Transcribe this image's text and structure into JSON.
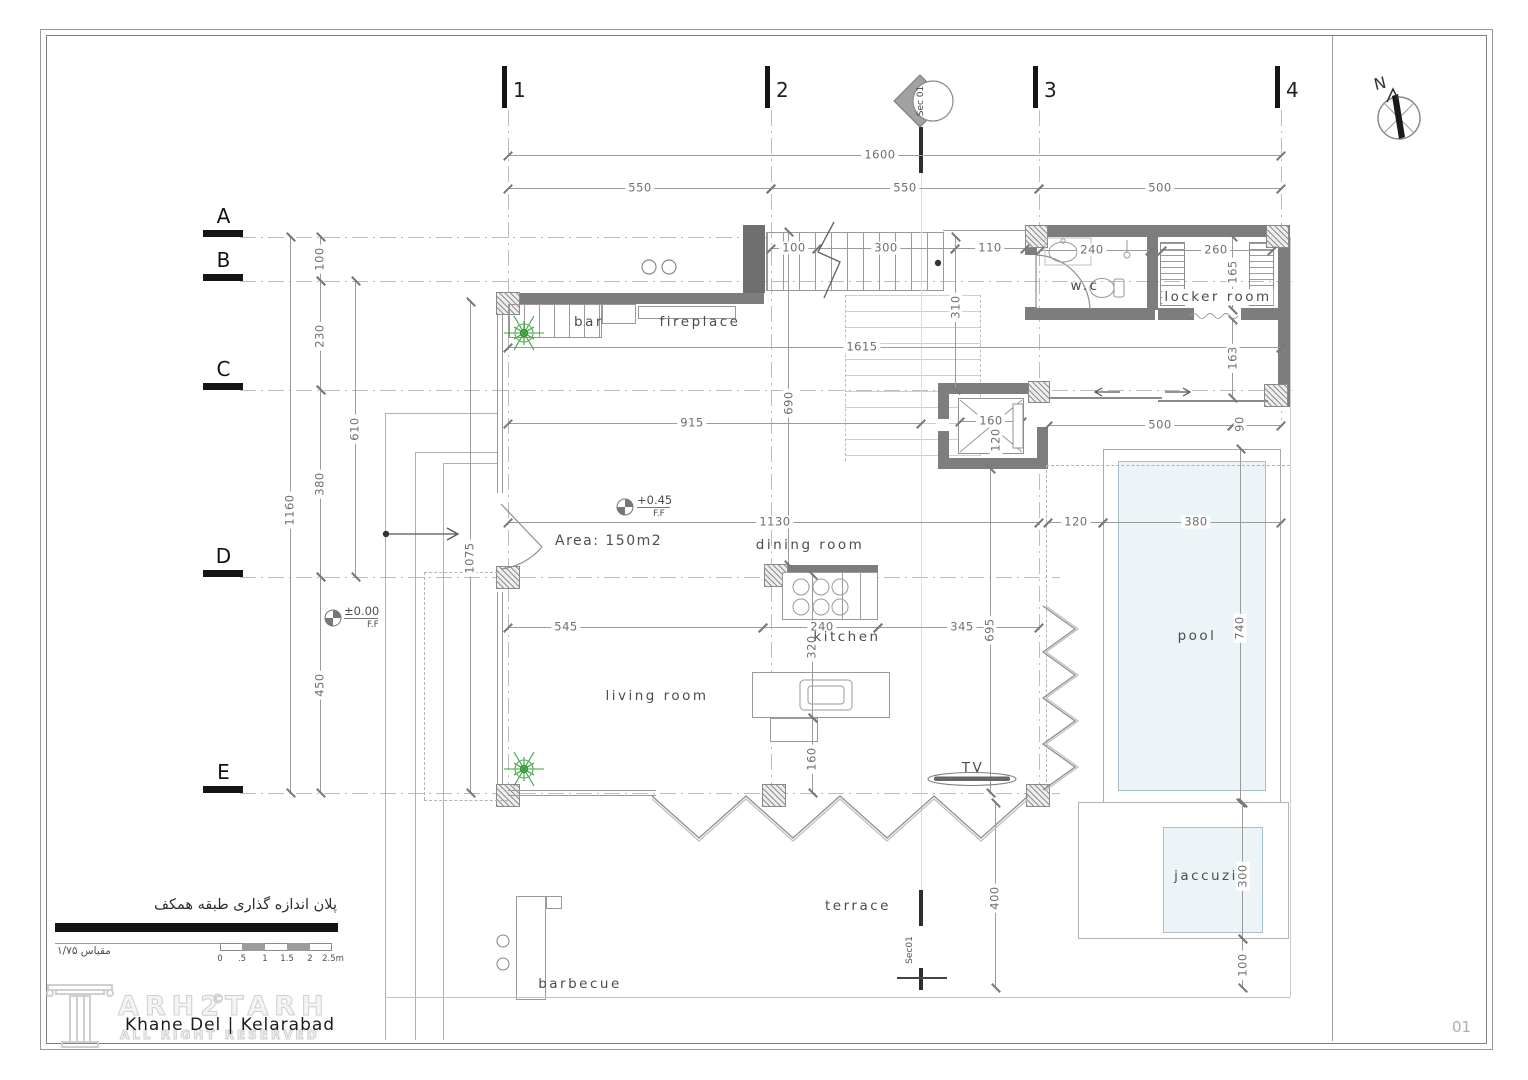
{
  "sheet": {
    "page": "01"
  },
  "north": {
    "label": "N"
  },
  "grid": {
    "cols": [
      "1",
      "2",
      "3",
      "4"
    ],
    "rows": [
      "A",
      "B",
      "C",
      "D",
      "E"
    ]
  },
  "section": {
    "top": "Sec 01",
    "bottom": "Sec01"
  },
  "rooms": {
    "bar": "bar",
    "fireplace": "fireplace",
    "wc": "w.c",
    "locker": "locker room",
    "dining": "dining room",
    "kitchen": "kitchen",
    "living": "living room",
    "pool": "pool",
    "jaccuzi": "jaccuzi",
    "terrace": "terrace",
    "barbecue": "barbecue",
    "tv": "TV"
  },
  "annotations": {
    "area": "Area: 150m2",
    "level_main": "+0.45",
    "level_ground": "±0.00",
    "ff": "F.F"
  },
  "dims": {
    "top_total": "1600",
    "top_b1": "550",
    "top_b2": "550",
    "top_b3": "500",
    "left_total": "1160",
    "left_ab": "100",
    "left_bc": "230",
    "left_cd": "380",
    "left_de": "450",
    "left_bd": "610",
    "stair_a": "100",
    "stair_b": "300",
    "stair_c": "110",
    "wc_w": "240",
    "locker_w": "260",
    "locker_h": "165",
    "locker_d": "163",
    "int_a": "1615",
    "int_b": "915",
    "int_c": "310",
    "int_d": "690",
    "dining_w": "1130",
    "pool_gap": "120",
    "pool_w": "380",
    "pool_h": "740",
    "living_a": "545",
    "kitchen_a": "240",
    "kitchen_b": "345",
    "kitchen_c": "320",
    "kitchen_d": "160",
    "living_h": "1075",
    "right_h": "695",
    "corr_a": "500",
    "corr_b": "90",
    "elev_a": "160",
    "elev_b": "120",
    "jac_a": "300",
    "jac_b": "100",
    "terrace_a": "400"
  },
  "titleblock": {
    "plan_title_fa": "پلان اندازه گذاری طبقه همکف",
    "scale_fa": "مقیاس ۱/۷۵",
    "project": "Khane Del | Kelarabad",
    "watermark": "ARH2TARH",
    "rights": "ALL RIGHT RESERVED",
    "copyright": "©"
  },
  "scalebar": {
    "t0": "0",
    "t05": ".5",
    "t1": "1",
    "t15": "1.5",
    "t2": "2",
    "t25": "2.5m"
  }
}
